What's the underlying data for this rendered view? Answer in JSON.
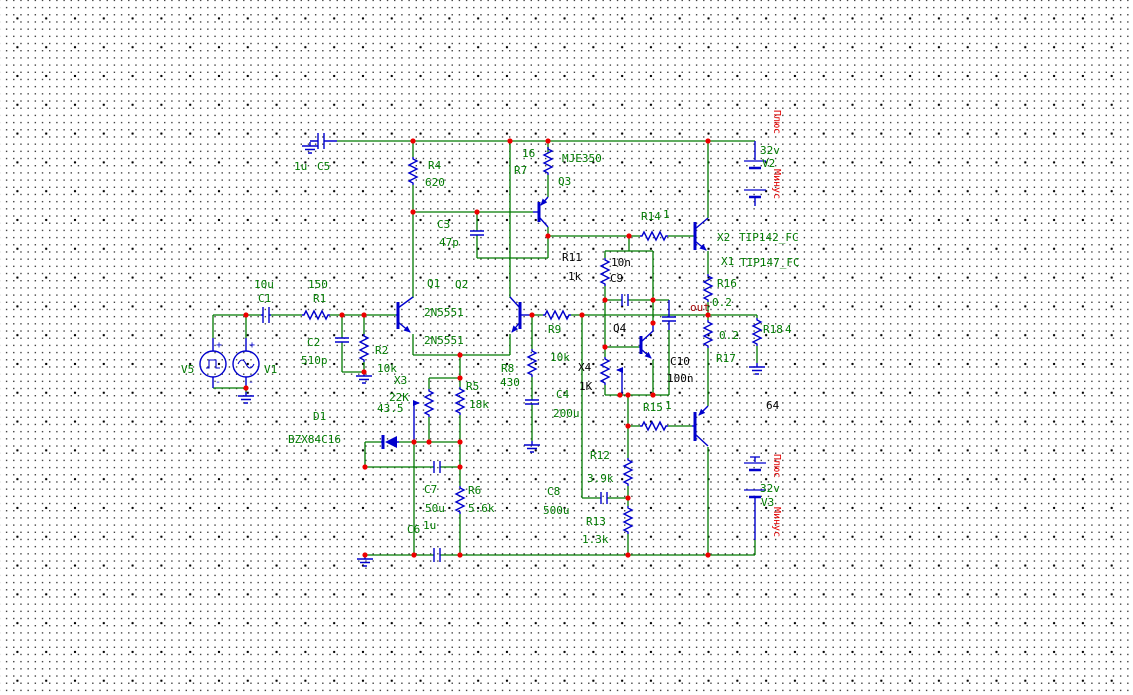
{
  "colors": {
    "wire_green": "#007A00",
    "component_blue": "#0000CD",
    "junction_red": "#EE0000",
    "label_green": "#007A00",
    "label_black": "#000000",
    "label_red": "#E00000",
    "net_label_maroon": "#A00000",
    "background": "#FFFFFF"
  },
  "parts": {
    "C5": {
      "name": "C5",
      "value": "1u"
    },
    "R4": {
      "name": "R4",
      "value": "620"
    },
    "R7": {
      "name": "R7",
      "value": "16"
    },
    "Q3": {
      "name": "Q3",
      "type": "MJE350"
    },
    "C3": {
      "name": "C3",
      "value": "47p"
    },
    "C1": {
      "name": "C1",
      "value": "10u"
    },
    "R1": {
      "name": "R1",
      "value": "150"
    },
    "C2": {
      "name": "C2",
      "value": "510p"
    },
    "R2": {
      "name": "R2",
      "value": "10k"
    },
    "V5": {
      "name": "V5"
    },
    "V1": {
      "name": "V1"
    },
    "Q1": {
      "name": "Q1",
      "type": "2N5551"
    },
    "Q2": {
      "name": "Q2",
      "type": "2N5551"
    },
    "X3": {
      "name": "X3",
      "value": "22K",
      "setting": "43.5"
    },
    "R5": {
      "name": "R5",
      "value": "18k"
    },
    "D1": {
      "name": "D1",
      "type": "BZX84C16"
    },
    "C7": {
      "name": "C7",
      "value": "50u"
    },
    "R6": {
      "name": "R6",
      "value": "5.6k"
    },
    "C6": {
      "name": "C6",
      "value": "1u"
    },
    "R9": {
      "name": "R9",
      "value": "10k"
    },
    "R8": {
      "name": "R8",
      "value": "430"
    },
    "C4": {
      "name": "C4",
      "value": "200u"
    },
    "R11": {
      "name": "R11",
      "value": "1k"
    },
    "C9": {
      "name": "C9",
      "value": "10n"
    },
    "Q4": {
      "name": "Q4"
    },
    "X4": {
      "name": "X4",
      "value": "1K"
    },
    "C10": {
      "name": "C10",
      "value": "100n"
    },
    "R14": {
      "name": "R14",
      "value": "1"
    },
    "R15": {
      "name": "R15",
      "value": "1"
    },
    "X2": {
      "name": "X2",
      "type": "TIP142_FC"
    },
    "X1": {
      "name": "X1",
      "type": "TIP147_FC"
    },
    "R16": {
      "name": "R16",
      "value": "0.2"
    },
    "R17": {
      "name": "R17",
      "value": "0.2"
    },
    "R18": {
      "name": "R18",
      "value": "4"
    },
    "R12": {
      "name": "R12",
      "value": "3.9k"
    },
    "C8": {
      "name": "C8",
      "value": "500u"
    },
    "R13": {
      "name": "R13",
      "value": "1.3k"
    },
    "V2": {
      "name": "V2",
      "value": "32v"
    },
    "V3": {
      "name": "V3",
      "value": "32v"
    }
  },
  "annotations": {
    "out": "out",
    "node_64": "64",
    "plus": "Плюс",
    "minus": "Минус",
    "v_plus": "+",
    "v_minus": "-"
  }
}
